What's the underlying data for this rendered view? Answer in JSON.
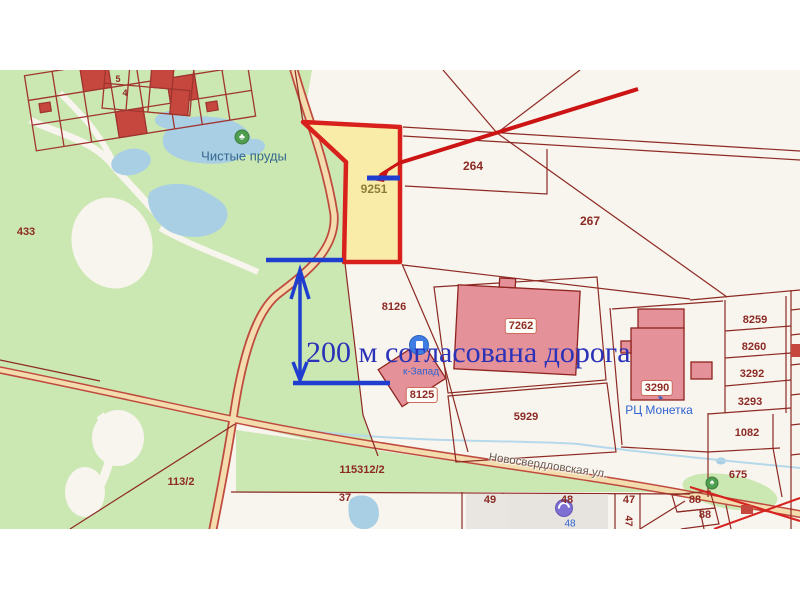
{
  "annotation": {
    "measure_text": "200 м согласована дорога"
  },
  "poi": {
    "ponds": "Чистые пруды",
    "monetka": "РЦ Монетка",
    "zapad": "к-Запад",
    "building48": "48"
  },
  "roads": {
    "novosverdlovskaya": "Новосвердловская ул."
  },
  "parcels": {
    "p5": "5",
    "p4": "4",
    "p433": "433",
    "p9251": "9251",
    "p264": "264",
    "p267": "267",
    "p8126": "8126",
    "p7262": "7262",
    "p8125": "8125",
    "p5929": "5929",
    "p3290": "3290",
    "p8259": "8259",
    "p8260": "8260",
    "p3292": "3292",
    "p3293": "3293",
    "p1082": "1082",
    "p675": "675",
    "p115312": "115312/2",
    "p113": "113/2",
    "p37": "37",
    "p49": "49",
    "p48": "48",
    "p47": "47",
    "p47r": "47",
    "p88a": "88",
    "p88b": "88"
  },
  "colors": {
    "forest": "#cbe7b2",
    "water": "#a9cfe5",
    "parcel_fill": "#f8f4ee",
    "highlight_fill": "#f9eca9",
    "highlight_border": "#d8211c",
    "boundary": "#8e2a24",
    "building": "#e59199",
    "annotation_blue": "#1f3ed0",
    "annotation_text_blue": "#2a32b8",
    "annotation_red": "#cc1414",
    "road_fill": "#f3dcae"
  }
}
